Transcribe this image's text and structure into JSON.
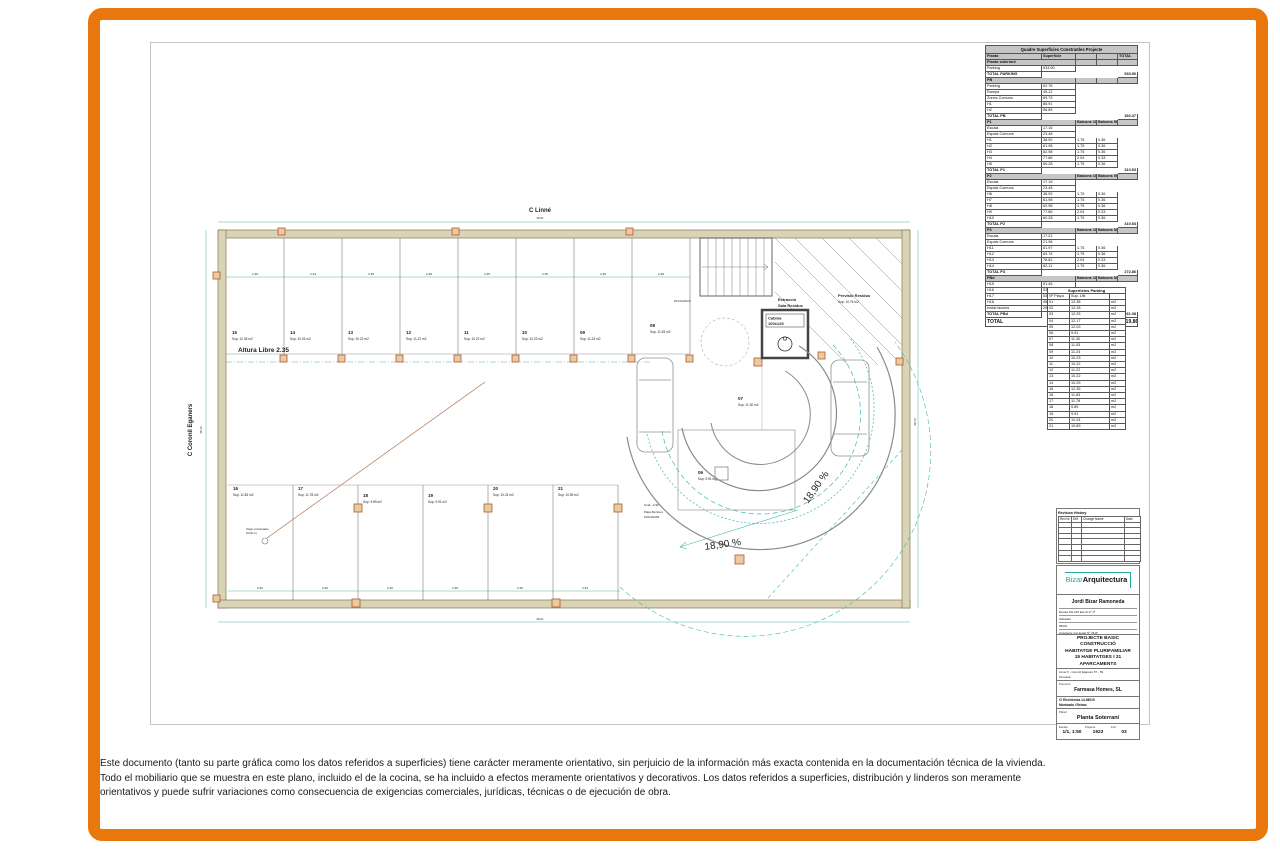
{
  "colors": {
    "accent_orange": "#E8770E",
    "accent_teal": "#22A79D",
    "wall_fill": "#DAD3B5"
  },
  "surfaces_table": {
    "title": "Quadre Superfícies Construïdes Projecte",
    "columns": [
      "Planta",
      "Superfície",
      "",
      "",
      "TOTAL"
    ],
    "rows": [
      {
        "t": "sec",
        "c": [
          "Planta soterrani",
          "",
          "",
          "",
          ""
        ]
      },
      {
        "c": [
          "Parking",
          "533.90",
          "",
          "",
          ""
        ]
      },
      {
        "t": "tot",
        "c": [
          "TOTAL PARKING",
          "",
          "",
          "",
          "533.90"
        ]
      },
      {
        "t": "sec",
        "c": [
          "PB",
          "",
          "",
          "",
          ""
        ]
      },
      {
        "c": [
          "Parking",
          "62.76",
          "",
          "",
          ""
        ]
      },
      {
        "c": [
          "Rampa",
          "45.12",
          "",
          "",
          ""
        ]
      },
      {
        "c": [
          "Zones Comuns",
          "69.73",
          "",
          "",
          ""
        ]
      },
      {
        "c": [
          "H1",
          "85.91",
          "",
          "",
          ""
        ]
      },
      {
        "c": [
          "H2",
          "96.85",
          "",
          "",
          ""
        ]
      },
      {
        "t": "tot",
        "c": [
          "TOTAL PB",
          "",
          "",
          "",
          "360.37"
        ]
      },
      {
        "t": "sec",
        "c": [
          "P1",
          "",
          "Balcons 100%",
          "Balcons 50%",
          ""
        ]
      },
      {
        "c": [
          "Escala",
          "17.16",
          "",
          "",
          ""
        ]
      },
      {
        "c": [
          "Espais Comuns",
          "23.48",
          "",
          "",
          ""
        ]
      },
      {
        "c": [
          "H1",
          "38.92",
          "1.75",
          "0.36",
          ""
        ]
      },
      {
        "c": [
          "H2",
          "61.98",
          "1.75",
          "0.36",
          ""
        ]
      },
      {
        "c": [
          "H3",
          "62.98",
          "1.75",
          "0.36",
          ""
        ]
      },
      {
        "c": [
          "H4",
          "77.86",
          "2.04",
          "0.33",
          ""
        ]
      },
      {
        "c": [
          "H5",
          "60.28",
          "1.75",
          "0.36",
          ""
        ]
      },
      {
        "t": "tot",
        "c": [
          "TOTAL P1",
          "",
          "",
          "",
          "310.53"
        ]
      },
      {
        "t": "sec",
        "c": [
          "P2",
          "",
          "Balcons 100%",
          "Balcons 50%",
          ""
        ]
      },
      {
        "c": [
          "Escala",
          "17.16",
          "",
          "",
          ""
        ]
      },
      {
        "c": [
          "Espais Comuns",
          "23.48",
          "",
          "",
          ""
        ]
      },
      {
        "c": [
          "H6",
          "38.92",
          "1.75",
          "0.36",
          ""
        ]
      },
      {
        "c": [
          "H7",
          "61.98",
          "1.75",
          "0.36",
          ""
        ]
      },
      {
        "c": [
          "H8",
          "62.98",
          "1.75",
          "0.36",
          ""
        ]
      },
      {
        "c": [
          "H9",
          "77.86",
          "2.04",
          "0.33",
          ""
        ]
      },
      {
        "c": [
          "H10",
          "60.28",
          "1.75",
          "0.36",
          ""
        ]
      },
      {
        "t": "tot",
        "c": [
          "TOTAL P2",
          "",
          "",
          "",
          "310.53"
        ]
      },
      {
        "t": "sec",
        "c": [
          "P3",
          "",
          "Balcons 100%",
          "Balcons 50%",
          ""
        ]
      },
      {
        "c": [
          "Escala",
          "17.21",
          "",
          "",
          ""
        ]
      },
      {
        "c": [
          "Espais Comuns",
          "21.98",
          "",
          "",
          ""
        ]
      },
      {
        "c": [
          "H11",
          "61.97",
          "1.75",
          "0.36",
          ""
        ]
      },
      {
        "c": [
          "H12",
          "63.74",
          "1.75",
          "0.36",
          ""
        ]
      },
      {
        "c": [
          "H13",
          "78.82",
          "2.04",
          "0.33",
          ""
        ]
      },
      {
        "c": [
          "H14",
          "62.11",
          "1.75",
          "0.36",
          ""
        ]
      },
      {
        "t": "tot",
        "c": [
          "TOTAL P3",
          "",
          "",
          "",
          "272.86"
        ]
      },
      {
        "t": "sec",
        "c": [
          "PBd",
          "",
          "Balcons 100%",
          "Balcons 50%",
          ""
        ]
      },
      {
        "c": [
          "H15",
          "51.46",
          "",
          "",
          ""
        ]
      },
      {
        "c": [
          "H16",
          "53.41",
          "",
          "",
          ""
        ]
      },
      {
        "c": [
          "H17",
          "53.48",
          "",
          "",
          ""
        ]
      },
      {
        "c": [
          "H18",
          "45.94",
          "",
          "",
          ""
        ]
      },
      {
        "c": [
          "Instal·lacions",
          "29.87",
          "",
          "",
          ""
        ]
      },
      {
        "t": "tot",
        "c": [
          "TOTAL PBd",
          "",
          "",
          "",
          "261.08"
        ]
      },
      {
        "t": "grand",
        "c": [
          "TOTAL",
          "2.119,86"
        ]
      }
    ]
  },
  "parking_table": {
    "title": "Superfícies Parking",
    "columns": [
      "Nº Plaça",
      "Sup. Útil",
      ""
    ],
    "rows": [
      [
        "01",
        "12.38",
        "m2"
      ],
      [
        "02",
        "12.28",
        "m2"
      ],
      [
        "03",
        "12.25",
        "m2"
      ],
      [
        "04",
        "12.17",
        "m2"
      ],
      [
        "05",
        "12.03",
        "m2"
      ],
      [
        "06",
        "9.91",
        "m2"
      ],
      [
        "07",
        "11.30",
        "m2"
      ],
      [
        "08",
        "11.53",
        "m2"
      ],
      [
        "09",
        "11.24",
        "m2"
      ],
      [
        "10",
        "10.23",
        "m2"
      ],
      [
        "11",
        "10.22",
        "m2"
      ],
      [
        "12",
        "11.22",
        "m2"
      ],
      [
        "13",
        "10.22",
        "m2"
      ],
      [
        "14",
        "10.25",
        "m2"
      ],
      [
        "15",
        "12.35",
        "m2"
      ],
      [
        "16",
        "11.83",
        "m2"
      ],
      [
        "17",
        "11.78",
        "m2"
      ],
      [
        "18",
        "9.89",
        "m2"
      ],
      [
        "19",
        "9.91",
        "m2"
      ],
      [
        "20",
        "10.24",
        "m2"
      ],
      [
        "21",
        "10.89",
        "m2"
      ]
    ]
  },
  "revision_box": {
    "title": "Revision History",
    "columns": [
      "Rev.Nr",
      "Drft",
      "Change Name",
      "Date"
    ],
    "rows": [
      {
        "c": [
          "",
          "",
          "",
          ""
        ]
      },
      {
        "c": [
          "",
          "",
          "",
          ""
        ]
      },
      {
        "c": [
          "",
          "",
          "",
          ""
        ]
      },
      {
        "c": [
          "",
          "",
          "",
          ""
        ]
      },
      {
        "c": [
          "",
          "",
          "",
          ""
        ]
      },
      {
        "c": [
          "",
          "",
          "",
          ""
        ]
      },
      {
        "c": [
          "",
          "",
          "",
          ""
        ]
      }
    ]
  },
  "title_block": {
    "logo_teal": "Bizar",
    "logo_dark": "Arquitectura",
    "architect": "Jordi Bizar Ramoneda",
    "addr1": "Escola Pia 166 Esc.D 2º 1ª",
    "addr2": "Sabadell",
    "addr3": "08201",
    "addr4": "Arquitecte Col·legiat Nº 7615",
    "proj1": "PROJECTE BASIC",
    "proj2": "CONSTRUCCIÓ",
    "proj3": "HABITATGE PLURIFAMILIAR",
    "proj4": "15 HABITATGES I 21",
    "proj5": "APARCAMENTS",
    "site1": "Linné 5 - Coronil Eganers 57 - 59",
    "site2": "Terrassa",
    "promotor_label": "Promotor",
    "promotor": "Farmasa Homes, SL",
    "paddr1": "C/ Electrònica 14-08915",
    "paddr2": "Montcada i Reixac",
    "planol_label": "Plànol",
    "planol": "Planta Soterrani",
    "escala_label": "Escala",
    "escala": "1/1, 1:50",
    "projecte_label": "Projecte",
    "projecte": "1923",
    "full_label": "Full",
    "full": "03"
  },
  "plan": {
    "street_top": "C Linné",
    "dim_top": "39.01",
    "street_left": "C Coronil Eganers",
    "dim_left": "38.13",
    "dim_bottom": "39.01",
    "dim_right": "38.14",
    "altura": "Altura Libre 2.35",
    "stalls": {
      "s15": {
        "num": "15",
        "sup": "Sup: 12.35 m2"
      },
      "s14": {
        "num": "14",
        "sup": "Sup: 10.25 m2"
      },
      "s13": {
        "num": "13",
        "sup": "Sup: 10.22 m2"
      },
      "s12": {
        "num": "12",
        "sup": "Sup: 11.22 m2"
      },
      "s11": {
        "num": "11",
        "sup": "Sup: 10.22 m2"
      },
      "s10": {
        "num": "10",
        "sup": "Sup: 10.23 m2"
      },
      "s09": {
        "num": "09",
        "sup": "Sup: 11.24 m2"
      },
      "s08": {
        "num": "08",
        "sup": "Sup: 11.53 m2"
      },
      "s07": {
        "num": "07",
        "sup": "Sup: 11.30 m2"
      },
      "s06": {
        "num": "06",
        "sup": "Sup: 9.91 m2"
      },
      "s16": {
        "num": "16",
        "sup": "Sup: 11.83 m2"
      },
      "s17": {
        "num": "17",
        "sup": "Sup: 11.78 m2"
      },
      "s18": {
        "num": "18",
        "sup": "Sup: 9.89 m2"
      },
      "s19": {
        "num": "19",
        "sup": "Sup: 9.91 m2"
      },
      "s20": {
        "num": "20",
        "sup": "Sup: 10.24 m2"
      },
      "s21": {
        "num": "21",
        "sup": "Sup: 10.89 m2"
      }
    },
    "top_dims": [
      "2.39",
      "2.24",
      "2.35",
      "2.39",
      "2.25",
      "2.35",
      "2.25",
      "2.39"
    ],
    "bottom_dims": [
      "2.62",
      "2.40",
      "2.20",
      "2.35",
      "2.20",
      "2.43"
    ],
    "cabina_l1": "Cabina",
    "cabina_l2": "100x125",
    "extraccio_l1": "Extracció",
    "extraccio_l2": "Sala Residus",
    "previsio_l1": "Previsió Residus",
    "previsio_l2": "Sup: 10.76 m2",
    "ramp_pct": "18,90 %",
    "cota": "Cota: -2.90",
    "bombers_l1": "Plaça Bombers",
    "bombers_l2": "100x100x50",
    "origin_l1": "Origen coordenades",
    "origin_l2": "(±0.00 m)",
    "eq1": "PR 100x45xC5"
  },
  "disclaimer": {
    "line1": "Este documento (tanto su parte gráfica como los datos referidos a superficies) tiene carácter meramente orientativo, sin perjuicio de la información más exacta contenida en la documentación técnica de la vivienda.",
    "line2": "Todo el mobiliario que se muestra en este plano, incluido el de la cocina, se ha incluido a efectos meramente orientativos y decorativos. Los datos referidos a superficies, distribución y linderos son meramente",
    "line3": "orientativos y puede sufrir variaciones como consecuencia de exigencias comerciales, jurídicas, técnicas o de ejecución de obra."
  }
}
